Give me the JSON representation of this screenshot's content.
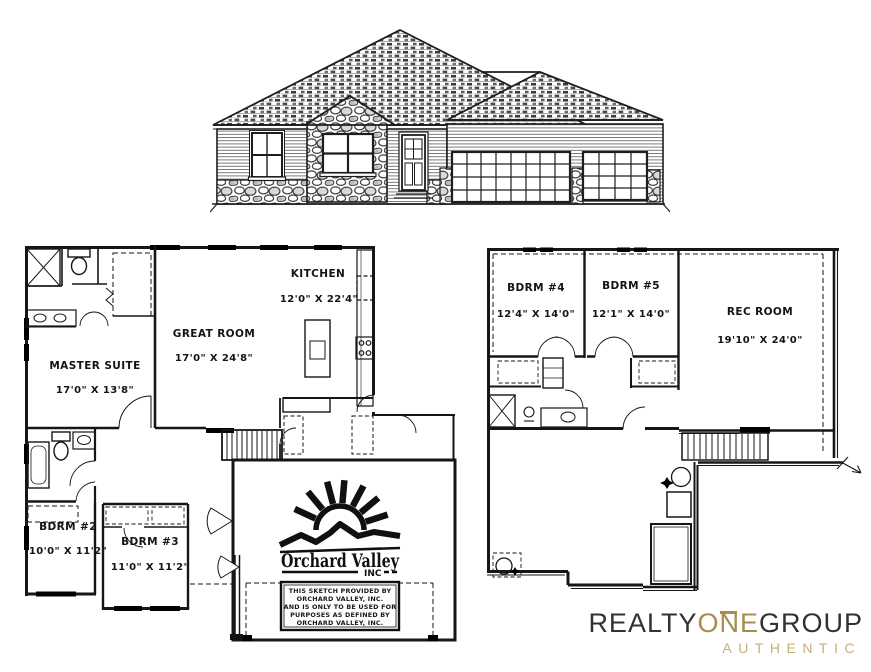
{
  "sheet": {
    "description": "Residential listing sheet: front elevation drawing, main floor plan, basement floor plan",
    "background": "#ffffff",
    "line_color": "#161616"
  },
  "main_floor": {
    "rooms": {
      "kitchen": {
        "name": "KITCHEN",
        "dims": "12'0\" X 22'4\""
      },
      "great_room": {
        "name": "GREAT ROOM",
        "dims": "17'0\" X 24'8\""
      },
      "master": {
        "name": "MASTER SUITE",
        "dims": "17'0\" X 13'8\""
      },
      "bdrm2": {
        "name": "BDRM #2",
        "dims": "10'0\" X 11'2\""
      },
      "bdrm3": {
        "name": "BDRM #3",
        "dims": "11'0\" X 11'2\""
      }
    }
  },
  "basement": {
    "rooms": {
      "bdrm4": {
        "name": "BDRM #4",
        "dims": "12'4\" X 14'0\""
      },
      "bdrm5": {
        "name": "BDRM #5",
        "dims": "12'1\" X 14'0\""
      },
      "rec_room": {
        "name": "REC ROOM",
        "dims": "19'10\" X 24'0\""
      }
    }
  },
  "builder": {
    "name": "Orchard Valley",
    "suffix": "INC",
    "disclaimer": {
      "line1": "THIS SKETCH PROVIDED BY",
      "line2": "ORCHARD VALLEY, INC.",
      "line3": "AND IS ONLY TO BE USED FOR",
      "line4": "PURPOSES AS DEFINED BY",
      "line5": "ORCHARD VALLEY, INC."
    }
  },
  "brokerage": {
    "word1": "REALTY",
    "word2": "ONE",
    "word3": "GROUP",
    "tagline": "AUTHENTIC",
    "colors": {
      "dark": "#35312d",
      "gold": "#a88d4d",
      "gold_light": "#c6b078"
    }
  }
}
